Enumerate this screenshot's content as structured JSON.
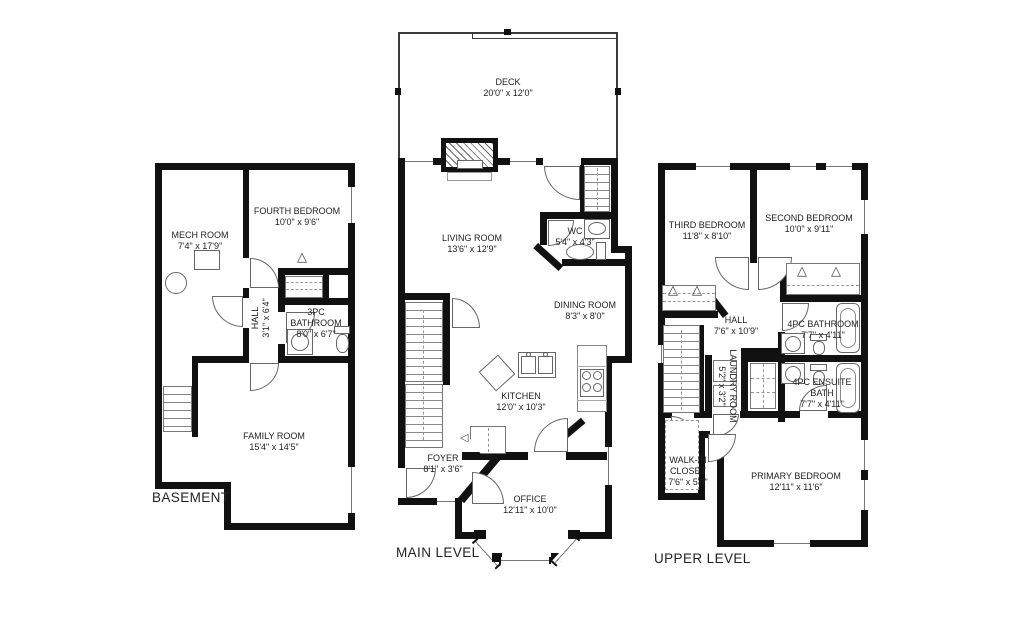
{
  "floorplan": {
    "levels": [
      {
        "id": "basement",
        "label": "BASEMENT",
        "rooms": [
          {
            "name": "MECH ROOM",
            "dims": "7'4\" x 17'9\""
          },
          {
            "name": "FOURTH BEDROOM",
            "dims": "10'0\" x 9'6\""
          },
          {
            "name": "HALL",
            "dims": "3'1\" x 6'4\""
          },
          {
            "name": "3PC BATHROOM",
            "dims": "8'0\" x 6'7\""
          },
          {
            "name": "FAMILY ROOM",
            "dims": "15'4\" x 14'5\""
          }
        ]
      },
      {
        "id": "main",
        "label": "MAIN LEVEL",
        "rooms": [
          {
            "name": "DECK",
            "dims": "20'0\" x 12'0\""
          },
          {
            "name": "LIVING ROOM",
            "dims": "13'6\" x 12'9\""
          },
          {
            "name": "WC",
            "dims": "5'4\" x 4'3\""
          },
          {
            "name": "DINING ROOM",
            "dims": "8'3\" x 8'0\""
          },
          {
            "name": "KITCHEN",
            "dims": "12'0\" x 10'3\""
          },
          {
            "name": "FOYER",
            "dims": "8'1\" x 3'6\""
          },
          {
            "name": "OFFICE",
            "dims": "12'11\" x 10'0\""
          }
        ]
      },
      {
        "id": "upper",
        "label": "UPPER LEVEL",
        "rooms": [
          {
            "name": "THIRD BEDROOM",
            "dims": "11'8\" x 8'10\""
          },
          {
            "name": "SECOND BEDROOM",
            "dims": "10'0\" x 9'11\""
          },
          {
            "name": "HALL",
            "dims": "7'6\" x 10'9\""
          },
          {
            "name": "4PC BATHROOM",
            "dims": "7'7\" x 4'11\""
          },
          {
            "name": "LAUNDRY ROOM",
            "dims": "5'2\" x 3'2\""
          },
          {
            "name": "4PC ENSUITE BATH",
            "dims": "7'7\" x 4'11\""
          },
          {
            "name": "WALK-IN CLOSET",
            "dims": "7'6\" x 5'8\""
          },
          {
            "name": "PRIMARY BEDROOM",
            "dims": "12'11\" x 11'6\""
          }
        ]
      }
    ],
    "colors": {
      "wall": "#111111",
      "line": "#666666",
      "text": "#1f1f1f",
      "bg": "#ffffff"
    }
  }
}
